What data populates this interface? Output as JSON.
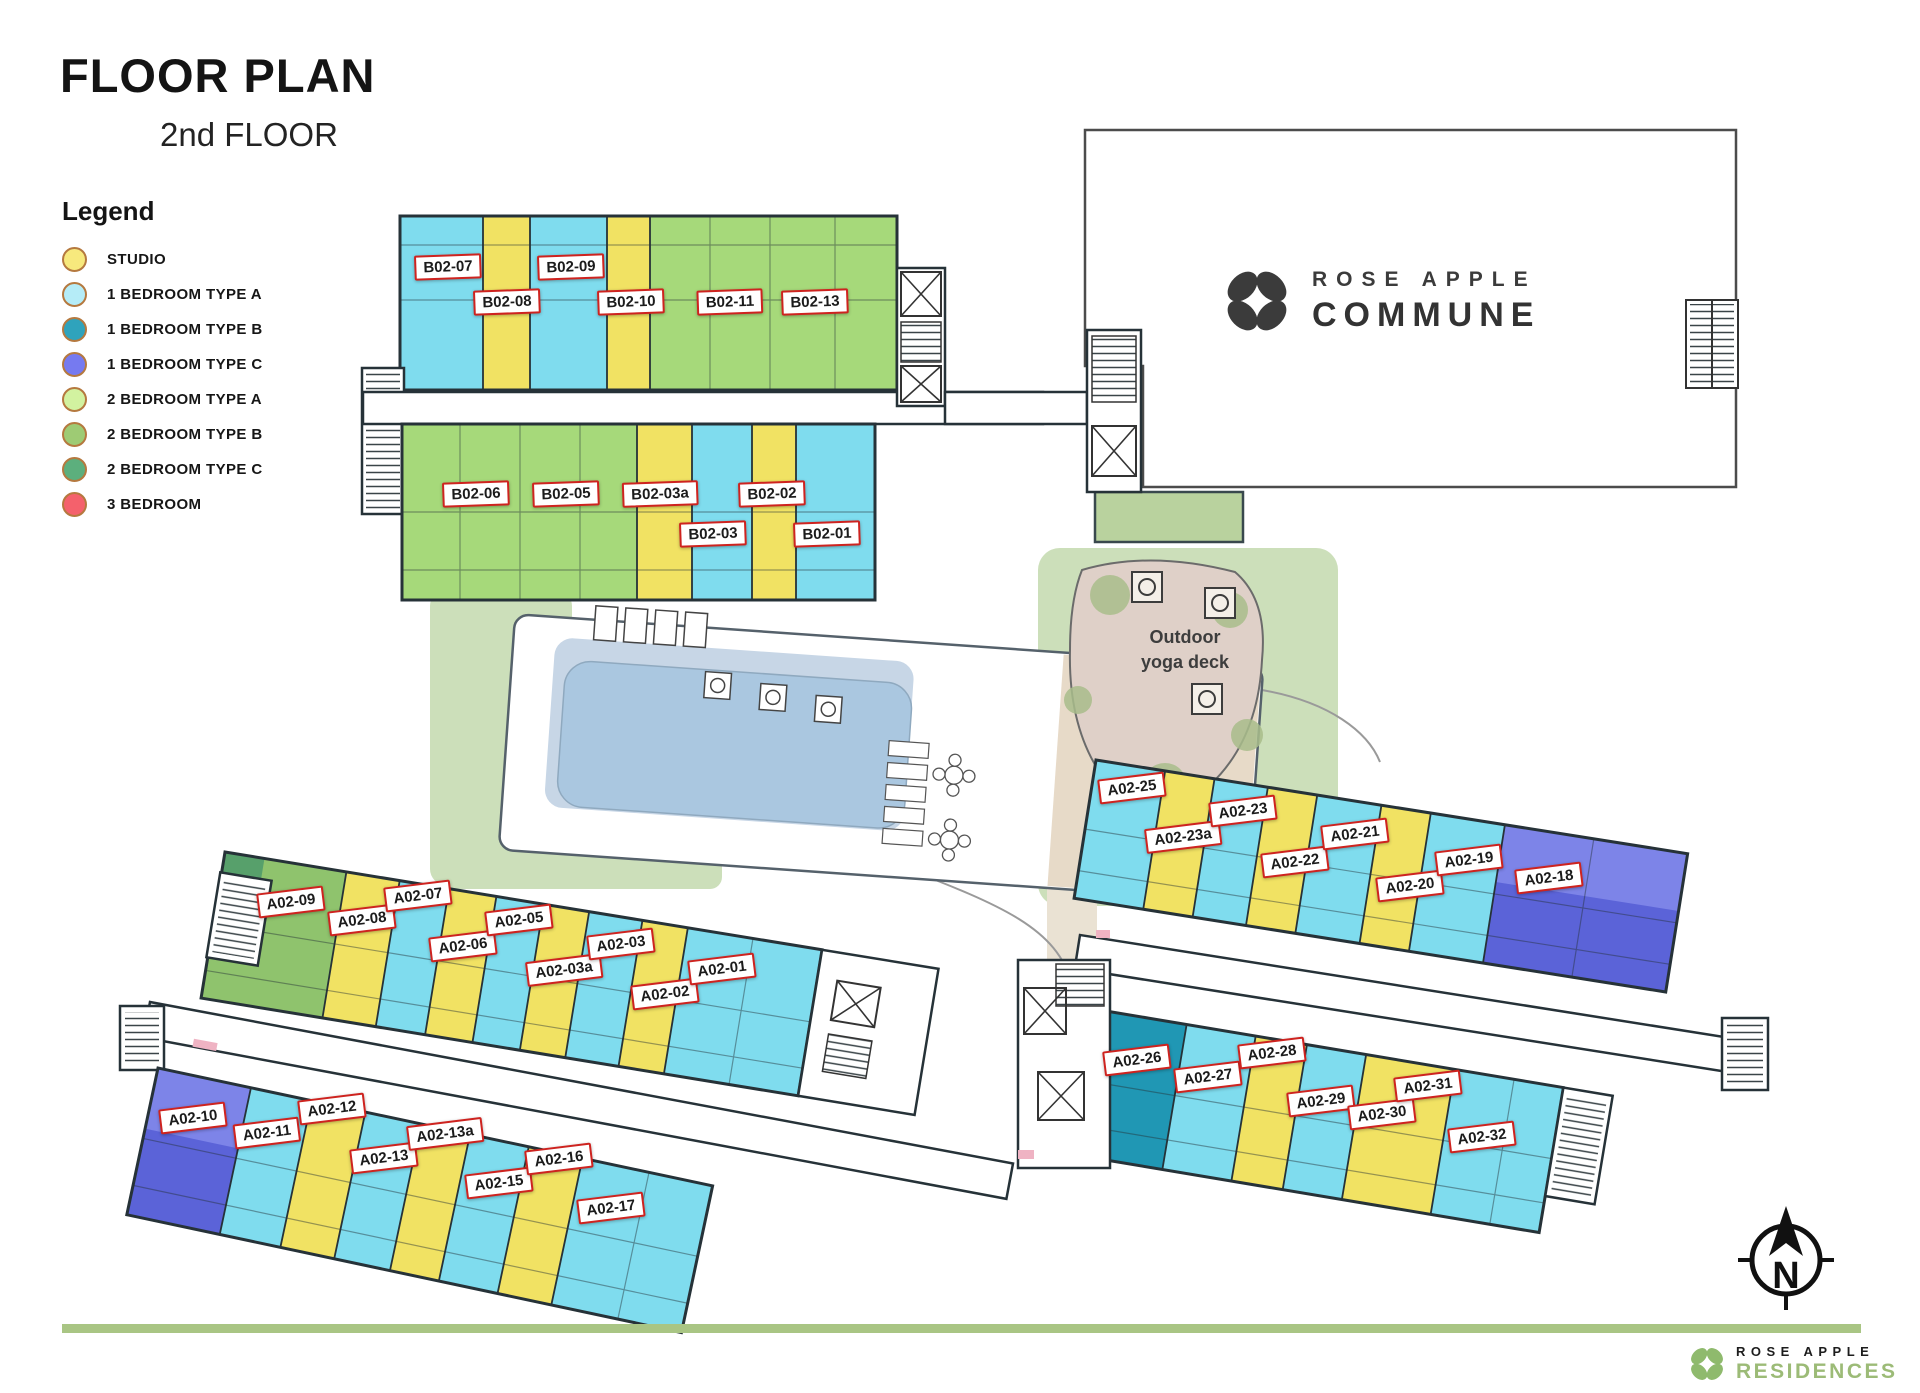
{
  "header": {
    "title": "FLOOR PLAN",
    "subtitle": "2nd FLOOR"
  },
  "legend": {
    "title": "Legend",
    "swatch_border": "#b5793f",
    "items": [
      {
        "key": "studio",
        "label": "STUDIO",
        "color": "#f7e97d"
      },
      {
        "key": "br1a",
        "label": "1 BEDROOM TYPE A",
        "color": "#b5ecf7"
      },
      {
        "key": "br1b",
        "label": "1 BEDROOM TYPE B",
        "color": "#2fa3bc"
      },
      {
        "key": "br1c",
        "label": "1 BEDROOM TYPE C",
        "color": "#767af0"
      },
      {
        "key": "br2a",
        "label": "2 BEDROOM TYPE A",
        "color": "#d2f2a0"
      },
      {
        "key": "br2b",
        "label": "2 BEDROOM TYPE B",
        "color": "#9ecb74"
      },
      {
        "key": "br2c",
        "label": "2 BEDROOM TYPE C",
        "color": "#5caf7d"
      },
      {
        "key": "br3",
        "label": "3 BEDROOM",
        "color": "#f4616c"
      }
    ]
  },
  "commune_logo": {
    "line1": "ROSE APPLE",
    "line2": "COMMUNE"
  },
  "compass": {
    "label": "N"
  },
  "footer": {
    "brand_line1": "ROSE APPLE",
    "brand_line2": "RESIDENCES",
    "bar_color": "#a9c584",
    "accent_green": "#9cbb77"
  },
  "plan": {
    "annotations": {
      "yoga_line1": "Outdoor",
      "yoga_line2": "yoga deck"
    },
    "colors": {
      "studio": "#f1e263",
      "br1a": "#7fdcee",
      "br1b": "#2097b4",
      "br1c": "#5b63d8",
      "br1c_light": "#7d84e8",
      "br2a": "#a6d97a",
      "br2b": "#8fc36d",
      "br2c": "#57a06b",
      "wall": "#263238",
      "lawn": "#ccdfba",
      "planter": "#b9d29e",
      "path": "#eae2d3",
      "pool_water": "#aac7e0",
      "pool_platform": "#c7d6e6",
      "deck_tan": "#e7dac8",
      "yoga_deck": "#dfd0c8",
      "bush": "#a9bd8b",
      "pink": "#efb3c3",
      "label_red": "#ce231f"
    },
    "unit_labels": [
      {
        "text": "B02-07",
        "x": 448,
        "y": 267,
        "rot": -2
      },
      {
        "text": "B02-08",
        "x": 507,
        "y": 302,
        "rot": -2
      },
      {
        "text": "B02-09",
        "x": 571,
        "y": 267,
        "rot": -2
      },
      {
        "text": "B02-10",
        "x": 631,
        "y": 302,
        "rot": -2
      },
      {
        "text": "B02-11",
        "x": 730,
        "y": 302,
        "rot": -2
      },
      {
        "text": "B02-13",
        "x": 815,
        "y": 302,
        "rot": -2
      },
      {
        "text": "B02-06",
        "x": 476,
        "y": 494,
        "rot": -2
      },
      {
        "text": "B02-05",
        "x": 566,
        "y": 494,
        "rot": -2
      },
      {
        "text": "B02-03a",
        "x": 660,
        "y": 494,
        "rot": -2
      },
      {
        "text": "B02-02",
        "x": 772,
        "y": 494,
        "rot": -2
      },
      {
        "text": "B02-03",
        "x": 713,
        "y": 534,
        "rot": -2
      },
      {
        "text": "B02-01",
        "x": 827,
        "y": 534,
        "rot": -2
      },
      {
        "text": "A02-09",
        "x": 291,
        "y": 902,
        "rot": -7
      },
      {
        "text": "A02-08",
        "x": 362,
        "y": 920,
        "rot": -7
      },
      {
        "text": "A02-07",
        "x": 418,
        "y": 896,
        "rot": -7
      },
      {
        "text": "A02-06",
        "x": 463,
        "y": 946,
        "rot": -7
      },
      {
        "text": "A02-05",
        "x": 519,
        "y": 920,
        "rot": -7
      },
      {
        "text": "A02-03a",
        "x": 564,
        "y": 970,
        "rot": -7
      },
      {
        "text": "A02-03",
        "x": 621,
        "y": 944,
        "rot": -7
      },
      {
        "text": "A02-02",
        "x": 665,
        "y": 994,
        "rot": -7
      },
      {
        "text": "A02-01",
        "x": 722,
        "y": 969,
        "rot": -7
      },
      {
        "text": "A02-10",
        "x": 193,
        "y": 1118,
        "rot": -7
      },
      {
        "text": "A02-11",
        "x": 267,
        "y": 1133,
        "rot": -7
      },
      {
        "text": "A02-12",
        "x": 332,
        "y": 1109,
        "rot": -7
      },
      {
        "text": "A02-13",
        "x": 384,
        "y": 1158,
        "rot": -7
      },
      {
        "text": "A02-13a",
        "x": 445,
        "y": 1134,
        "rot": -7
      },
      {
        "text": "A02-15",
        "x": 499,
        "y": 1183,
        "rot": -7
      },
      {
        "text": "A02-16",
        "x": 559,
        "y": 1159,
        "rot": -7
      },
      {
        "text": "A02-17",
        "x": 611,
        "y": 1208,
        "rot": -7
      },
      {
        "text": "A02-25",
        "x": 1132,
        "y": 788,
        "rot": -7
      },
      {
        "text": "A02-23a",
        "x": 1183,
        "y": 837,
        "rot": -7
      },
      {
        "text": "A02-23",
        "x": 1243,
        "y": 811,
        "rot": -7
      },
      {
        "text": "A02-22",
        "x": 1295,
        "y": 862,
        "rot": -7
      },
      {
        "text": "A02-21",
        "x": 1355,
        "y": 834,
        "rot": -7
      },
      {
        "text": "A02-20",
        "x": 1410,
        "y": 886,
        "rot": -7
      },
      {
        "text": "A02-19",
        "x": 1469,
        "y": 860,
        "rot": -7
      },
      {
        "text": "A02-18",
        "x": 1549,
        "y": 878,
        "rot": -7
      },
      {
        "text": "A02-26",
        "x": 1137,
        "y": 1060,
        "rot": -7
      },
      {
        "text": "A02-27",
        "x": 1208,
        "y": 1077,
        "rot": -7
      },
      {
        "text": "A02-28",
        "x": 1272,
        "y": 1053,
        "rot": -7
      },
      {
        "text": "A02-29",
        "x": 1321,
        "y": 1101,
        "rot": -7
      },
      {
        "text": "A02-30",
        "x": 1382,
        "y": 1114,
        "rot": -7
      },
      {
        "text": "A02-31",
        "x": 1428,
        "y": 1086,
        "rot": -7
      },
      {
        "text": "A02-32",
        "x": 1482,
        "y": 1137,
        "rot": -7
      }
    ]
  }
}
